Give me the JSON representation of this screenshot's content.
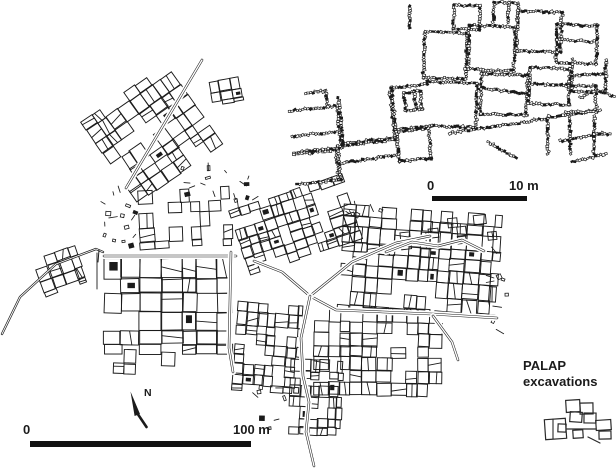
{
  "figure": {
    "background": "#ffffff",
    "ink": "#1b1b1b",
    "type_note": "archaeological site plan figure"
  },
  "main_map": {
    "north_label": "N",
    "scale_bar": {
      "start_label": "0",
      "end_label": "100 m"
    }
  },
  "inset_map": {
    "scale_bar": {
      "start_label": "0",
      "end_label": "10 m"
    }
  },
  "palap": {
    "title_line1": "PALAP",
    "title_line2": "excavations"
  }
}
